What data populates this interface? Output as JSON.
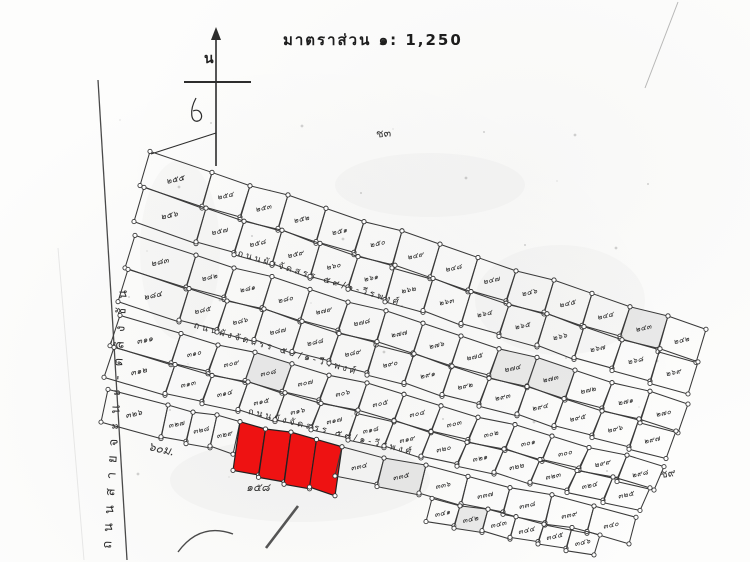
{
  "title": {
    "text": "มาตราส่วน ๑: 1,250"
  },
  "compass": {
    "north_label": "น"
  },
  "roads": {
    "main_road_name": "ถนนสายจะนะ-ตลิ่งชัน",
    "internal_road_labels": [
      "ถนนผังจัดสรร ๕๙/๑-วีรพงศ์",
      "ถนนผังจัดสรร ๕๙/๑-วีรพงศ์",
      "ถนนผังจัดสรร ๕๙/๑-วีรพงศ์"
    ]
  },
  "annotations": {
    "upper": "ช๓",
    "right": "ช๙",
    "bottom": "๑๕๘",
    "distance": "๖๐ม."
  },
  "highlight": {
    "color": "#ee1212",
    "plot_count": 4
  },
  "line_color": "#3a3a3a",
  "grid": {
    "rows": [
      {
        "name": "row-1",
        "wide_label": "๒๕๕",
        "cells": [
          "๒๕๔",
          "๒๕๓",
          "๒๕๒",
          "๒๕๑",
          "๒๕๐",
          "๒๔๙",
          "๒๔๘",
          "๒๔๗",
          "๒๔๖",
          "๒๔๕",
          "๒๔๔",
          "๒๔๓",
          "๒๔๒"
        ],
        "red": [],
        "shaded": [
          11
        ]
      },
      {
        "name": "row-2",
        "wide_label": "๒๕๖",
        "cells": [
          "๒๕๗",
          "๒๕๘",
          "๒๕๙",
          "๒๖๐",
          "๒๖๑",
          "๒๖๒",
          "๒๖๓",
          "๒๖๔",
          "๒๖๕",
          "๒๖๖",
          "๒๖๗",
          "๒๖๘",
          "๒๖๙"
        ],
        "red": [],
        "shaded": []
      },
      {
        "name": "row-3",
        "wide_label": "๒๘๓",
        "cells": [
          "๒๘๒",
          "๒๘๑",
          "๒๘๐",
          "๒๗๙",
          "๒๗๘",
          "๒๗๗",
          "๒๗๖",
          "๒๗๕",
          "๒๗๔",
          "๒๗๓",
          "๒๗๒",
          "๒๗๑",
          "๒๗๐"
        ],
        "red": [],
        "shaded": [
          8,
          9
        ]
      },
      {
        "name": "row-4",
        "wide_label": "๒๘๔",
        "cells": [
          "๒๘๕",
          "๒๘๖",
          "๒๘๗",
          "๒๘๘",
          "๒๘๙",
          "๒๙๐",
          "๒๙๑",
          "๒๙๒",
          "๒๙๓",
          "๒๙๔",
          "๒๙๕",
          "๒๙๖",
          "๒๙๗"
        ],
        "red": [],
        "shaded": []
      },
      {
        "name": "row-5",
        "wide_label": "๓๑๑",
        "cells": [
          "๓๑๐",
          "๓๐๙",
          "๓๐๘",
          "๓๐๗",
          "๓๐๖",
          "๓๐๕",
          "๓๐๔",
          "๓๐๓",
          "๓๐๒",
          "๓๐๑",
          "๓๐๐",
          "๒๙๙",
          "๒๙๘"
        ],
        "red": [],
        "shaded": [
          2
        ]
      },
      {
        "name": "row-6",
        "wide_label": "๓๑๒",
        "cells": [
          "๓๑๓",
          "๓๑๔",
          "๓๑๕",
          "๓๑๖",
          "๓๑๗",
          "๓๑๘",
          "๓๑๙",
          "๓๒๐",
          "๓๒๑",
          "๓๒๒",
          "๓๒๓",
          "๓๒๔",
          "๓๒๕"
        ],
        "red": [],
        "shaded": []
      },
      {
        "name": "row-7",
        "wide_label": "๓๒๖",
        "cells": [
          "๓๒๗",
          "๓๒๘",
          "๓๒๙",
          "",
          "",
          "",
          "",
          "๓๓๔",
          "๓๓๕",
          "๓๓๖",
          "๓๓๗",
          "๓๓๘",
          "๓๓๙",
          "๓๔๐"
        ],
        "red": [
          3,
          4,
          5,
          6
        ],
        "shaded": [
          8
        ]
      },
      {
        "name": "row-8",
        "cells": [
          "๓๔๑",
          "๓๔๒",
          "๓๔๓",
          "๓๔๔",
          "๓๔๕",
          "๓๔๖"
        ],
        "red": [],
        "shaded": [
          1
        ]
      }
    ]
  }
}
